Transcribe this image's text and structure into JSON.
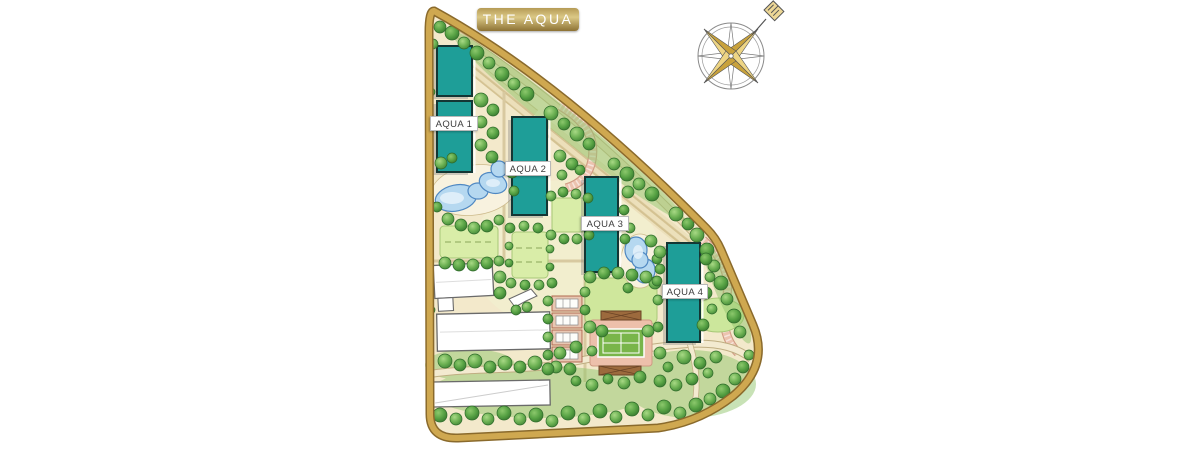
{
  "title": {
    "banner_label": "THE AQUA"
  },
  "map": {
    "buildings": [
      {
        "id": "aqua-1",
        "label": "AQUA 1"
      },
      {
        "id": "aqua-2",
        "label": "AQUA 2"
      },
      {
        "id": "aqua-3",
        "label": "AQUA 3"
      },
      {
        "id": "aqua-4",
        "label": "AQUA 4"
      }
    ],
    "features": [
      {
        "name": "perimeter-road"
      },
      {
        "name": "lagoon-pool"
      },
      {
        "name": "kidney-pool"
      },
      {
        "name": "tennis-court"
      },
      {
        "name": "clubhouse-buildings"
      },
      {
        "name": "villa-row"
      },
      {
        "name": "lawns"
      },
      {
        "name": "walking-paths"
      },
      {
        "name": "parking-stripes"
      },
      {
        "name": "tree-landscape"
      }
    ],
    "colors": {
      "building_teal": "#1E9E98",
      "road_gold": "#C9A24B",
      "ground_cream": "#F3E9CB",
      "tree_green": "#5BA547",
      "pool_blue": "#B5D8F0",
      "banner_gold": "#B59A55",
      "court_pink": "#ECC3AF"
    }
  },
  "compass": {
    "icon_name": "compass-rose-icon"
  }
}
